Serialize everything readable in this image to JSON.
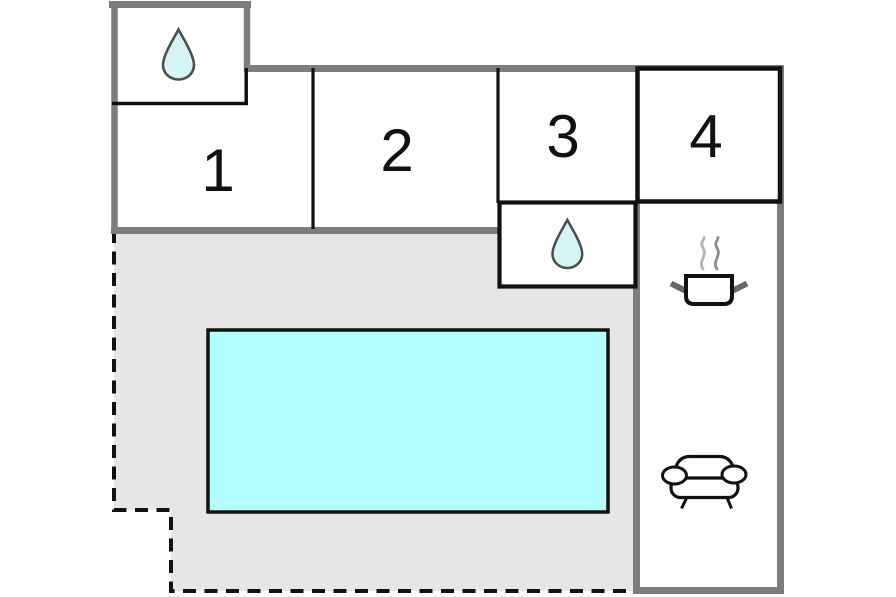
{
  "floorplan": {
    "kind": "holiday-home-floor-plan",
    "rooms": [
      {
        "id": "room-1",
        "label": "1"
      },
      {
        "id": "room-2",
        "label": "2"
      },
      {
        "id": "room-3",
        "label": "3"
      },
      {
        "id": "room-4",
        "label": "4"
      }
    ],
    "features": [
      {
        "id": "bathroom-annex-top-left",
        "icon": "water-drop-icon"
      },
      {
        "id": "bathroom-inner",
        "icon": "water-drop-icon"
      },
      {
        "id": "kitchen",
        "icon": "cooking-pot-icon"
      },
      {
        "id": "lounge",
        "icon": "sofa-icon"
      },
      {
        "id": "swimming-pool",
        "icon": "pool-rectangle"
      },
      {
        "id": "terrace",
        "icon": "dashed-boundary-area"
      }
    ],
    "colors": {
      "pool": "#b2ffff",
      "droplet": "#d4f4f6",
      "droplet_outline": "#4d4d4d",
      "terrace": "#e6e6e6",
      "wall_gray": "#7d7d7d",
      "line_black": "#111111",
      "steam_light": "#b3b3b3",
      "steam_dark": "#8c8c8c",
      "handle_gray": "#666666",
      "background": "#ffffff"
    }
  }
}
